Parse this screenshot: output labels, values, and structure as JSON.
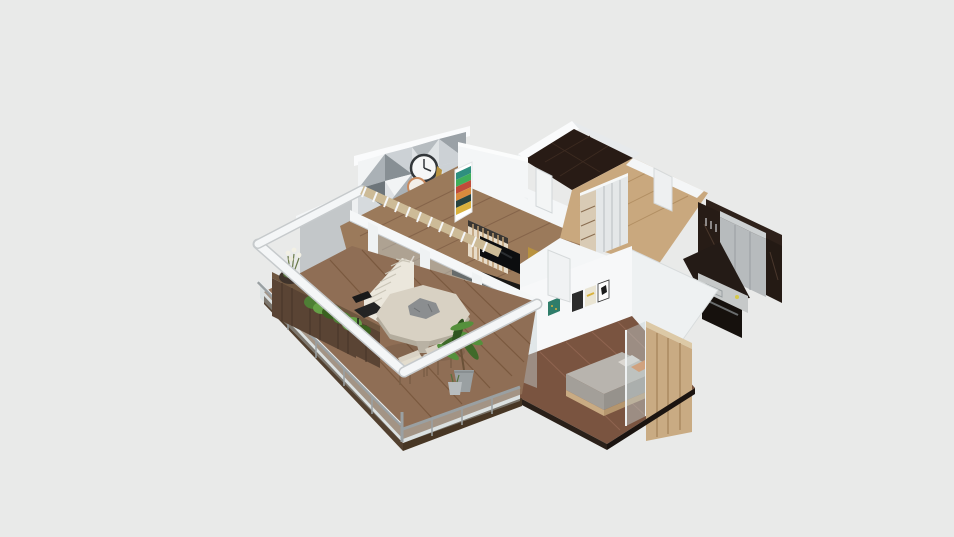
{
  "meta": {
    "canvas_width": 954,
    "canvas_height": 537
  },
  "scene": {
    "type": "isometric-3d-floorplan-render",
    "objects": [
      "balcony-deck",
      "glass-railing",
      "planter-boxes",
      "shrubs",
      "flower-pot",
      "round-dining-table",
      "table-centerpiece",
      "black-chair",
      "outdoor-chairs",
      "potted-plant",
      "staircase",
      "pergola-beams",
      "slatted-trellis",
      "living-room-floor",
      "geometric-accent-wall",
      "wall-clock",
      "copper-clock",
      "colorful-ladder-shelf",
      "wood-slat-partition",
      "tv-screen",
      "media-cabinet",
      "gold-art-panels",
      "sliding-glass-wall",
      "bathroom-dark-tile-floor",
      "bathroom-door",
      "hallway-wood-floor",
      "hallway-door",
      "wardrobe-closet",
      "kitchen-dark-marble-wall",
      "kitchen-tall-cabinets",
      "kitchen-counter-sink",
      "kitchen-oven",
      "bedroom-art-wall",
      "bedroom-wall-frames",
      "bedroom-door",
      "bedroom-wood-floor",
      "bed",
      "orange-pillow",
      "headboard-wood-partition",
      "bedroom-glass-panel",
      "white-ceiling-wedge",
      "exterior-gray-wall"
    ]
  },
  "colors": {
    "bg": "#e9eae9",
    "wallBright": "#fafbfc",
    "wallLit": "#f4f6f7",
    "wallShade": "#e7eaec",
    "wallGray": "#c3c7c9",
    "woodLight": "#c9a87e",
    "woodMid": "#9b7a5b",
    "woodDeck": "#8f6e55",
    "woodDark": "#7a5440",
    "darkTile": "#281b15",
    "darkTile2": "#241b16",
    "cabinetGray": "#b7bbbd",
    "counterGray": "#c6c9c9",
    "glass": "#c5d2d5",
    "metal": "#9aa0a2",
    "tableTop": "#d8d1c3",
    "tableRim": "#b3ac9d",
    "stairCream": "#ebe7dc",
    "planterWood": "#5a4434",
    "plantDark": "#3a611f",
    "plantMid": "#4e7f35",
    "plantLight": "#66a147",
    "accentTeal": "#2e8f7f",
    "accentGreen": "#3fae5a",
    "accentRed": "#c04b3a",
    "accentOrange": "#d98a3d",
    "accentYellow": "#d9b23d",
    "gold": "#b8923f",
    "clockCopper": "#c98a5e",
    "tvBlack": "#0c0d0f",
    "pillowOrange": "#d97b3a",
    "bedGray": "#b8b4ae",
    "partitionTan": "#c9ab83"
  }
}
